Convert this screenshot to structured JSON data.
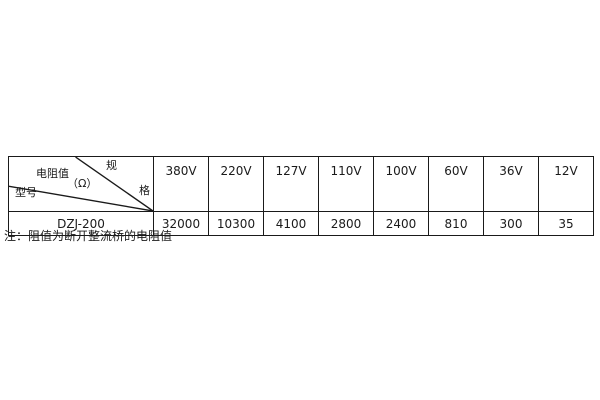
{
  "colors": {
    "background": "#ffffff",
    "border": "#1a1a1a",
    "text": "#1a1a1a"
  },
  "table": {
    "corner": {
      "spec_label_full": "规格",
      "spec_top_char": "规",
      "spec_bottom_char": "格",
      "value_label": "电阻值",
      "value_unit": "（Ω）",
      "row_label": "型号"
    },
    "voltages": [
      "380V",
      "220V",
      "127V",
      "110V",
      "100V",
      "60V",
      "36V",
      "12V"
    ],
    "rows": [
      {
        "model": "DZJ-200",
        "values": [
          "32000",
          "10300",
          "4100",
          "2800",
          "2400",
          "810",
          "300",
          "35"
        ]
      }
    ]
  },
  "note": "注：阻值为断开整流桥的电阻值"
}
